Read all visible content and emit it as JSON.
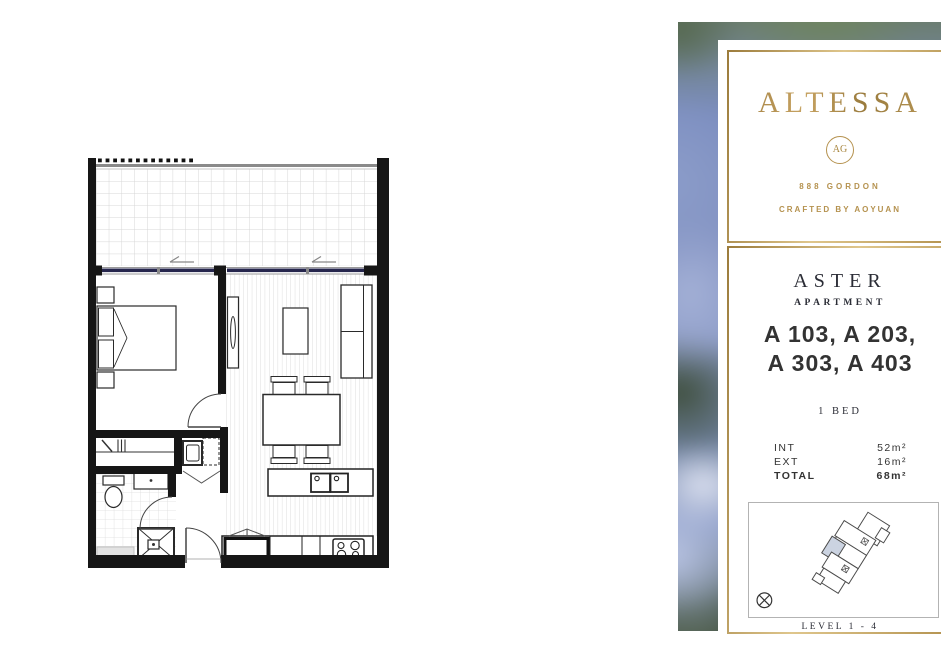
{
  "brand": {
    "name": "ALTESSA",
    "monogram": "AG",
    "address": "888 GORDON",
    "tagline": "CRAFTED BY AOYUAN"
  },
  "apartment": {
    "name": "ASTER",
    "type_label": "APARTMENT",
    "units_line1": "A 103, A 203,",
    "units_line2": "A 303, A 403",
    "bed_label": "1 BED",
    "areas": [
      {
        "label": "INT",
        "value": "52m²"
      },
      {
        "label": "EXT",
        "value": "16m²"
      },
      {
        "label": "TOTAL",
        "value": "68m²"
      }
    ],
    "level_label": "LEVEL 1 - 4"
  },
  "icons": {
    "monogram_badge": "ag-monogram-icon",
    "compass": "compass-icon"
  },
  "colors": {
    "gold": "#b5924f",
    "gold_light": "#dfc68c",
    "text_dark": "#2b2d36",
    "glass_navy": "#26264d",
    "unit_highlight": "#cbd3e1"
  }
}
